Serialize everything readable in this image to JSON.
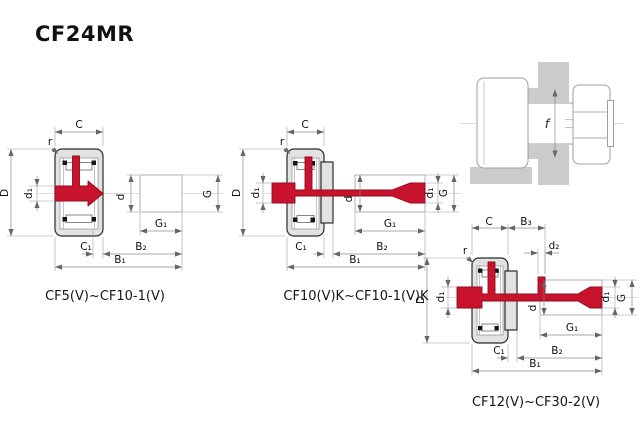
{
  "title": "CF24MR",
  "colors": {
    "accent_red": "#c9122b",
    "bearing_gray": "#e2e2e2",
    "wall_gray": "#cbcbcb",
    "outline_dark": "#2b2b2b",
    "dim_gray": "#8a8a8a"
  },
  "mounted_view": {
    "labels": {
      "f": "f"
    }
  },
  "diagrams": [
    {
      "caption": "CF5(V)~CF10-1(V)",
      "labels": {
        "C": "C",
        "r": "r",
        "D": "D",
        "d1": "d₁",
        "d": "d",
        "G": "G",
        "G1": "G₁",
        "C1": "C₁",
        "B2": "B₂",
        "B1": "B₁"
      }
    },
    {
      "caption": "CF10(V)K~CF10-1(V)K",
      "labels": {
        "C": "C",
        "r": "r",
        "D": "D",
        "d1": "d₁",
        "d": "d",
        "G": "G",
        "G1": "G₁",
        "C1": "C₁",
        "B2": "B₂",
        "B1": "B₁",
        "d1_right": "d₁"
      }
    },
    {
      "caption": "CF12(V)~CF30-2(V)",
      "labels": {
        "C": "C",
        "B3": "B₃",
        "r": "r",
        "D": "D",
        "d1": "d₁",
        "d2": "d₂",
        "d": "d",
        "G": "G",
        "G1": "G₁",
        "C1": "C₁",
        "B2": "B₂",
        "B1": "B₁",
        "d1_right": "d₁"
      }
    }
  ]
}
